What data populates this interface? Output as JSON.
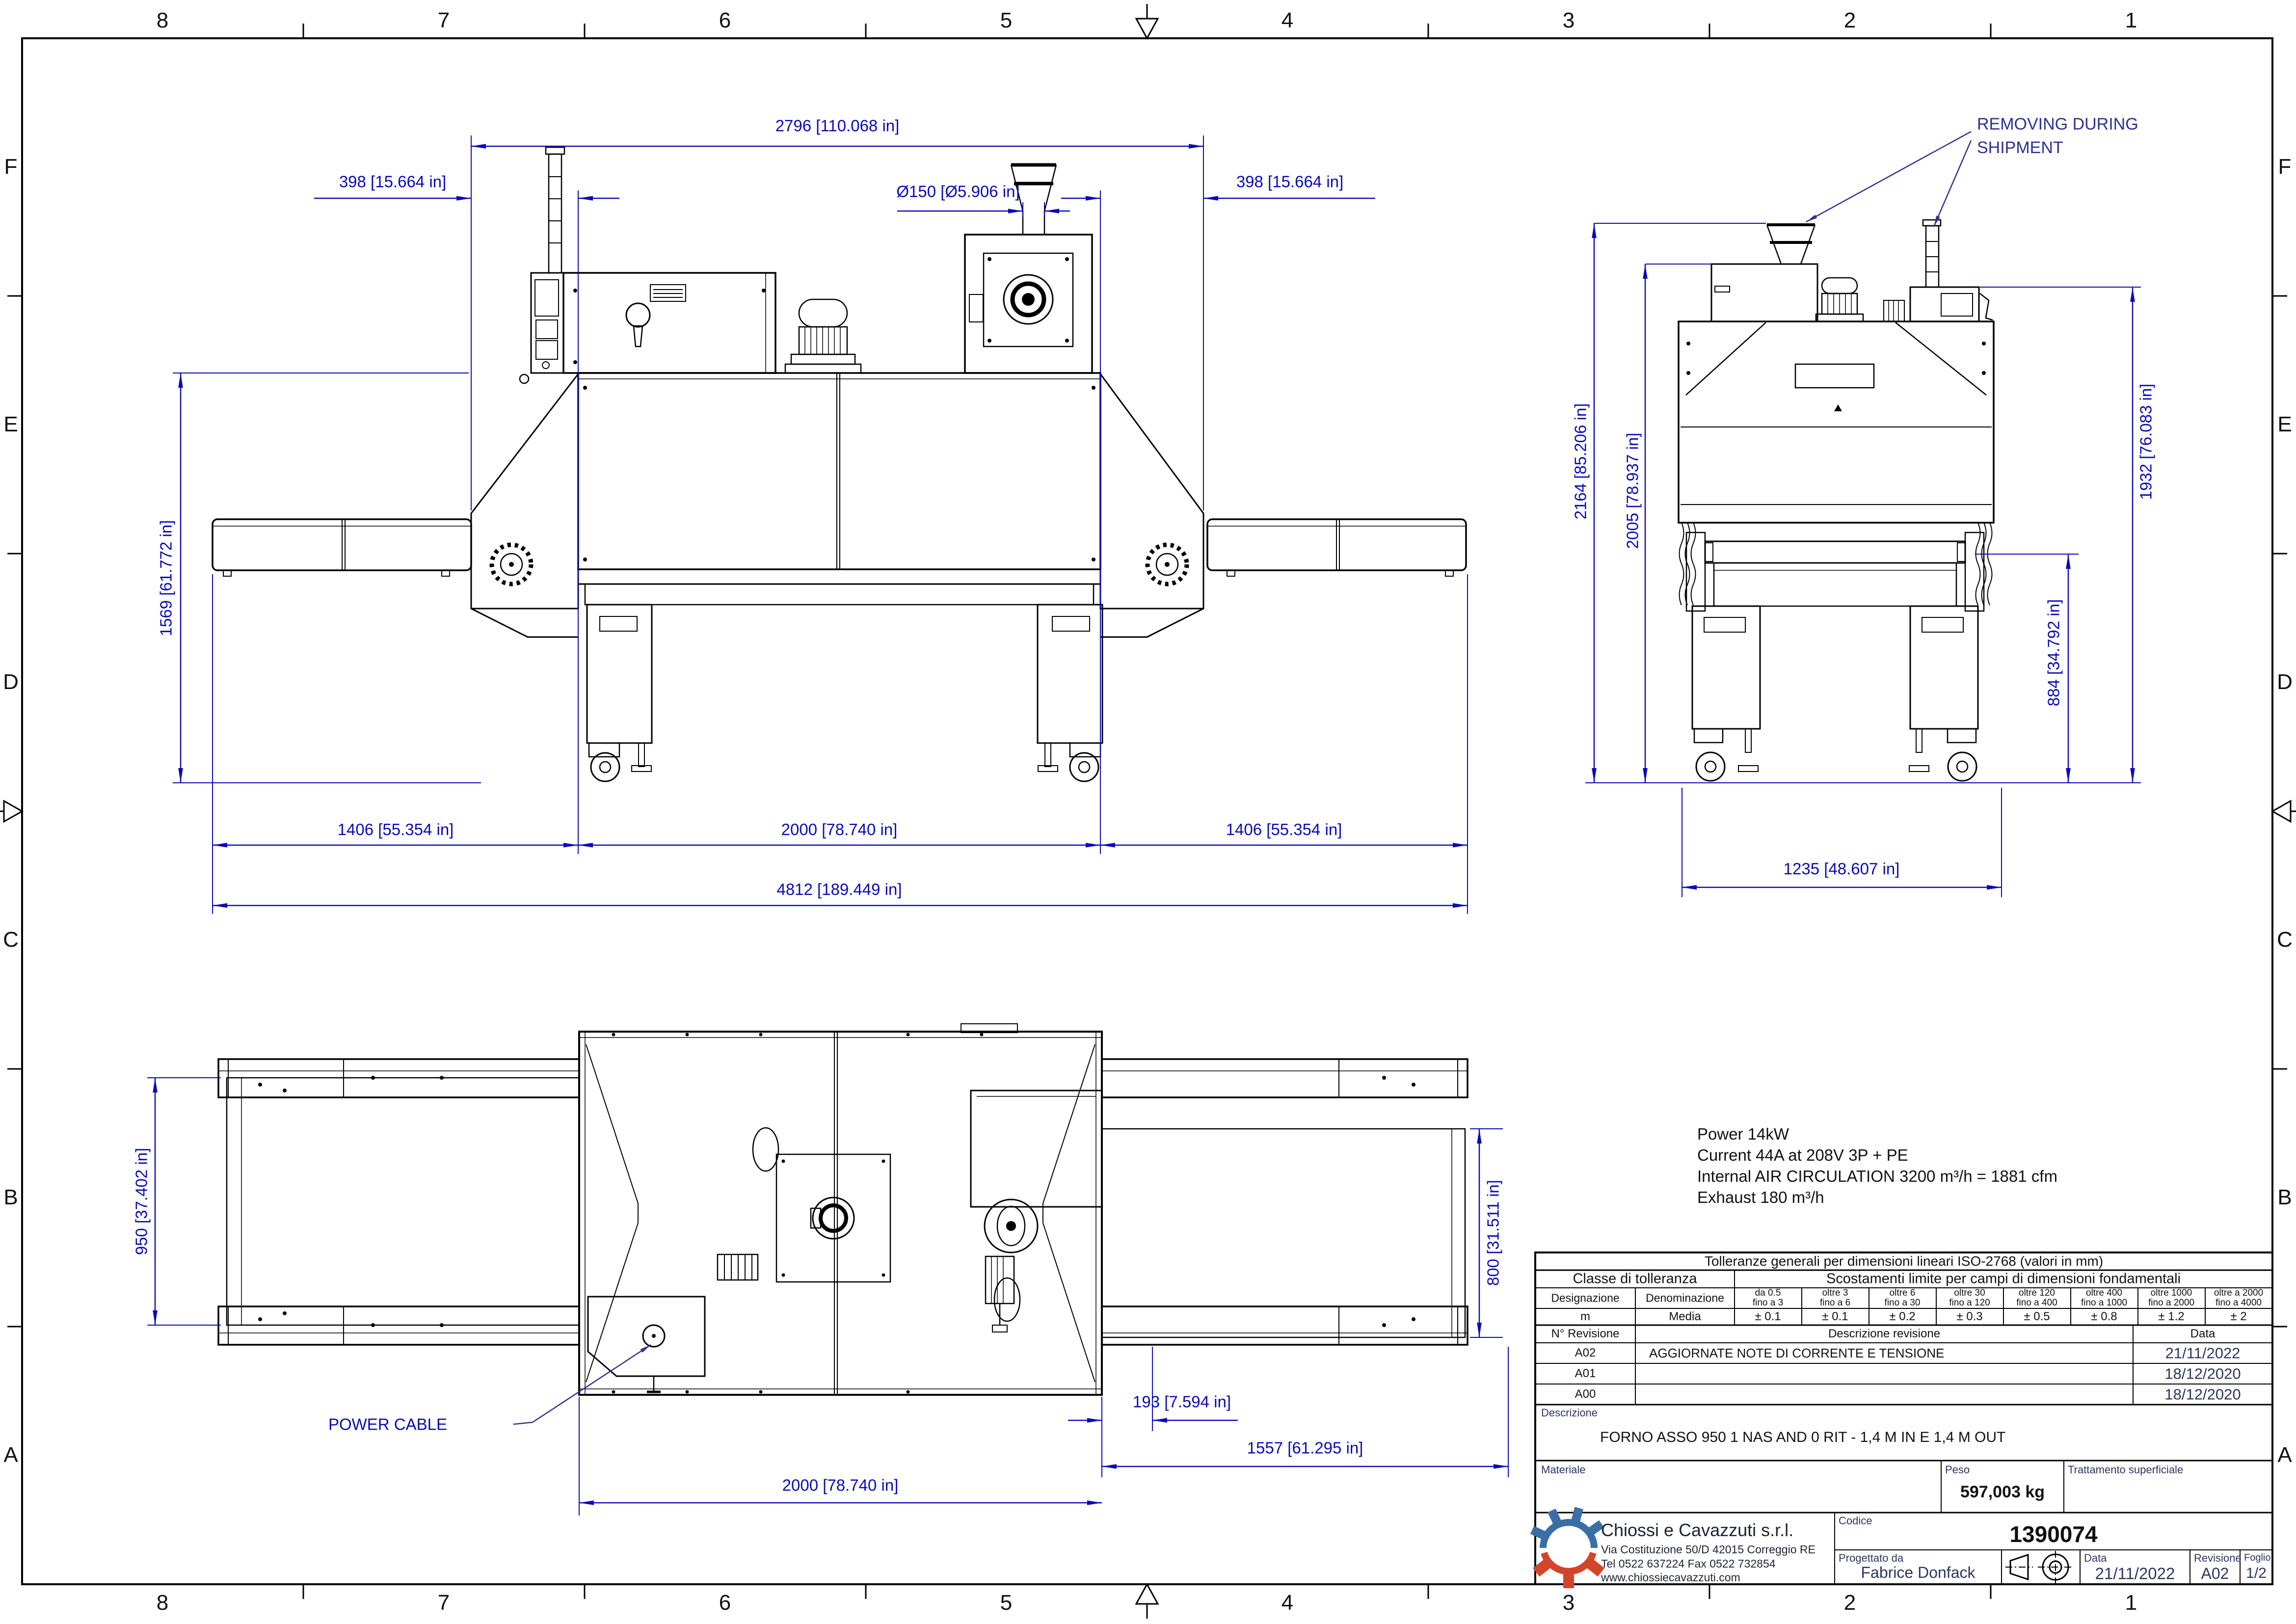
{
  "frame": {
    "cols": [
      "8",
      "7",
      "6",
      "5",
      "4",
      "3",
      "2",
      "1"
    ],
    "rows": [
      "F",
      "E",
      "D",
      "C",
      "B",
      "A"
    ]
  },
  "views": {
    "front": {
      "dims": {
        "top_width": "2796 [110.068 in]",
        "offset_left": "398 [15.664 in]",
        "duct": "Ø150 [Ø5.906 in]",
        "offset_right": "398 [15.664 in]",
        "belt_height": "1569 [61.772 in]",
        "infeed_len": "1406 [55.354 in]",
        "oven_len": "2000 [78.740 in]",
        "outfeed_len": "1406 [55.354 in]",
        "total_len": "4812 [189.449 in]"
      }
    },
    "side": {
      "removing_line1": "REMOVING DURING",
      "removing_line2": "SHIPMENT",
      "dims": {
        "h_max": "2164 [85.206 in]",
        "h_cabinet": "2005 [78.937 in]",
        "h_blower": "1932 [76.083 in]",
        "h_belt": "884 [34.792 in]",
        "w_base": "1235 [48.607 in]"
      }
    },
    "plan": {
      "power_cable_label": "POWER CABLE",
      "dims": {
        "belt_in_width": "950 [37.402 in]",
        "belt_out_width": "800 [31.511 in]",
        "offset": "193 [7.594 in]",
        "outfeed_total": "1557 [61.295 in]",
        "oven_len": "2000 [78.740 in]"
      }
    }
  },
  "notes": {
    "l1": "Power 14kW",
    "l2": "Current 44A at 208V 3P + PE",
    "l3": "Internal AIR CIRCULATION 3200 m³/h = 1881 cfm",
    "l4": "Exhaust 180 m³/h"
  },
  "tolerance_table": {
    "title": "Tolleranze generali per dimensioni lineari ISO-2768 (valori in mm)",
    "classe": "Classe di tolleranza",
    "scostamenti": "Scostamenti limite per campi di dimensioni fondamentali",
    "col_designazione": "Designazione",
    "col_denominazione": "Denominazione",
    "ranges": [
      {
        "l1": "da 0.5",
        "l2": "fino a 3"
      },
      {
        "l1": "oltre 3",
        "l2": "fino a 6"
      },
      {
        "l1": "oltre 6",
        "l2": "fino a 30"
      },
      {
        "l1": "oltre 30",
        "l2": "fino a 120"
      },
      {
        "l1": "oltre 120",
        "l2": "fino a 400"
      },
      {
        "l1": "oltre 400",
        "l2": "fino a 1000"
      },
      {
        "l1": "oltre 1000",
        "l2": "fino a 2000"
      },
      {
        "l1": "oltre a 2000",
        "l2": "fino a 4000"
      }
    ],
    "row": {
      "designazione": "m",
      "denominazione": "Media",
      "values": [
        "± 0.1",
        "± 0.1",
        "± 0.2",
        "± 0.3",
        "± 0.5",
        "± 0.8",
        "± 1.2",
        "± 2"
      ]
    }
  },
  "revision_table": {
    "h_num": "N° Revisione",
    "h_desc": "Descrizione revisione",
    "h_date": "Data",
    "rows": [
      {
        "num": "A02",
        "desc": "AGGIORNATE NOTE DI CORRENTE E TENSIONE",
        "date": "21/11/2022"
      },
      {
        "num": "A01",
        "desc": "",
        "date": "18/12/2020"
      },
      {
        "num": "A00",
        "desc": "",
        "date": "18/12/2020"
      }
    ]
  },
  "title_block": {
    "descrizione_label": "Descrizione",
    "descrizione": "FORNO ASSO 950 1 NAS AND 0 RIT - 1,4 M IN E 1,4 M OUT",
    "materiale_label": "Materiale",
    "peso_label": "Peso",
    "peso": "597,003 kg",
    "trattamento_label": "Trattamento superficiale",
    "company": {
      "name": "Chiossi e Cavazzuti s.r.l.",
      "address": "Via Costituzione 50/D 42015 Correggio RE",
      "phone": "Tel 0522 637224 Fax 0522 732854",
      "website": "www.chiossiecavazzuti.com"
    },
    "codice_label": "Codice",
    "codice": "1390074",
    "progettato_label": "Progettato da",
    "progettato": "Fabrice Donfack",
    "data_label": "Data",
    "data": "21/11/2022",
    "revisione_label": "Revisione",
    "revisione": "A02",
    "foglio_label": "Foglio",
    "foglio": "1/2"
  },
  "colors": {
    "dimension_blue": "#0a0ab8",
    "leader_navy": "#2d3192",
    "logo_blue": "#3a6ea5",
    "logo_red": "#d2452b"
  }
}
